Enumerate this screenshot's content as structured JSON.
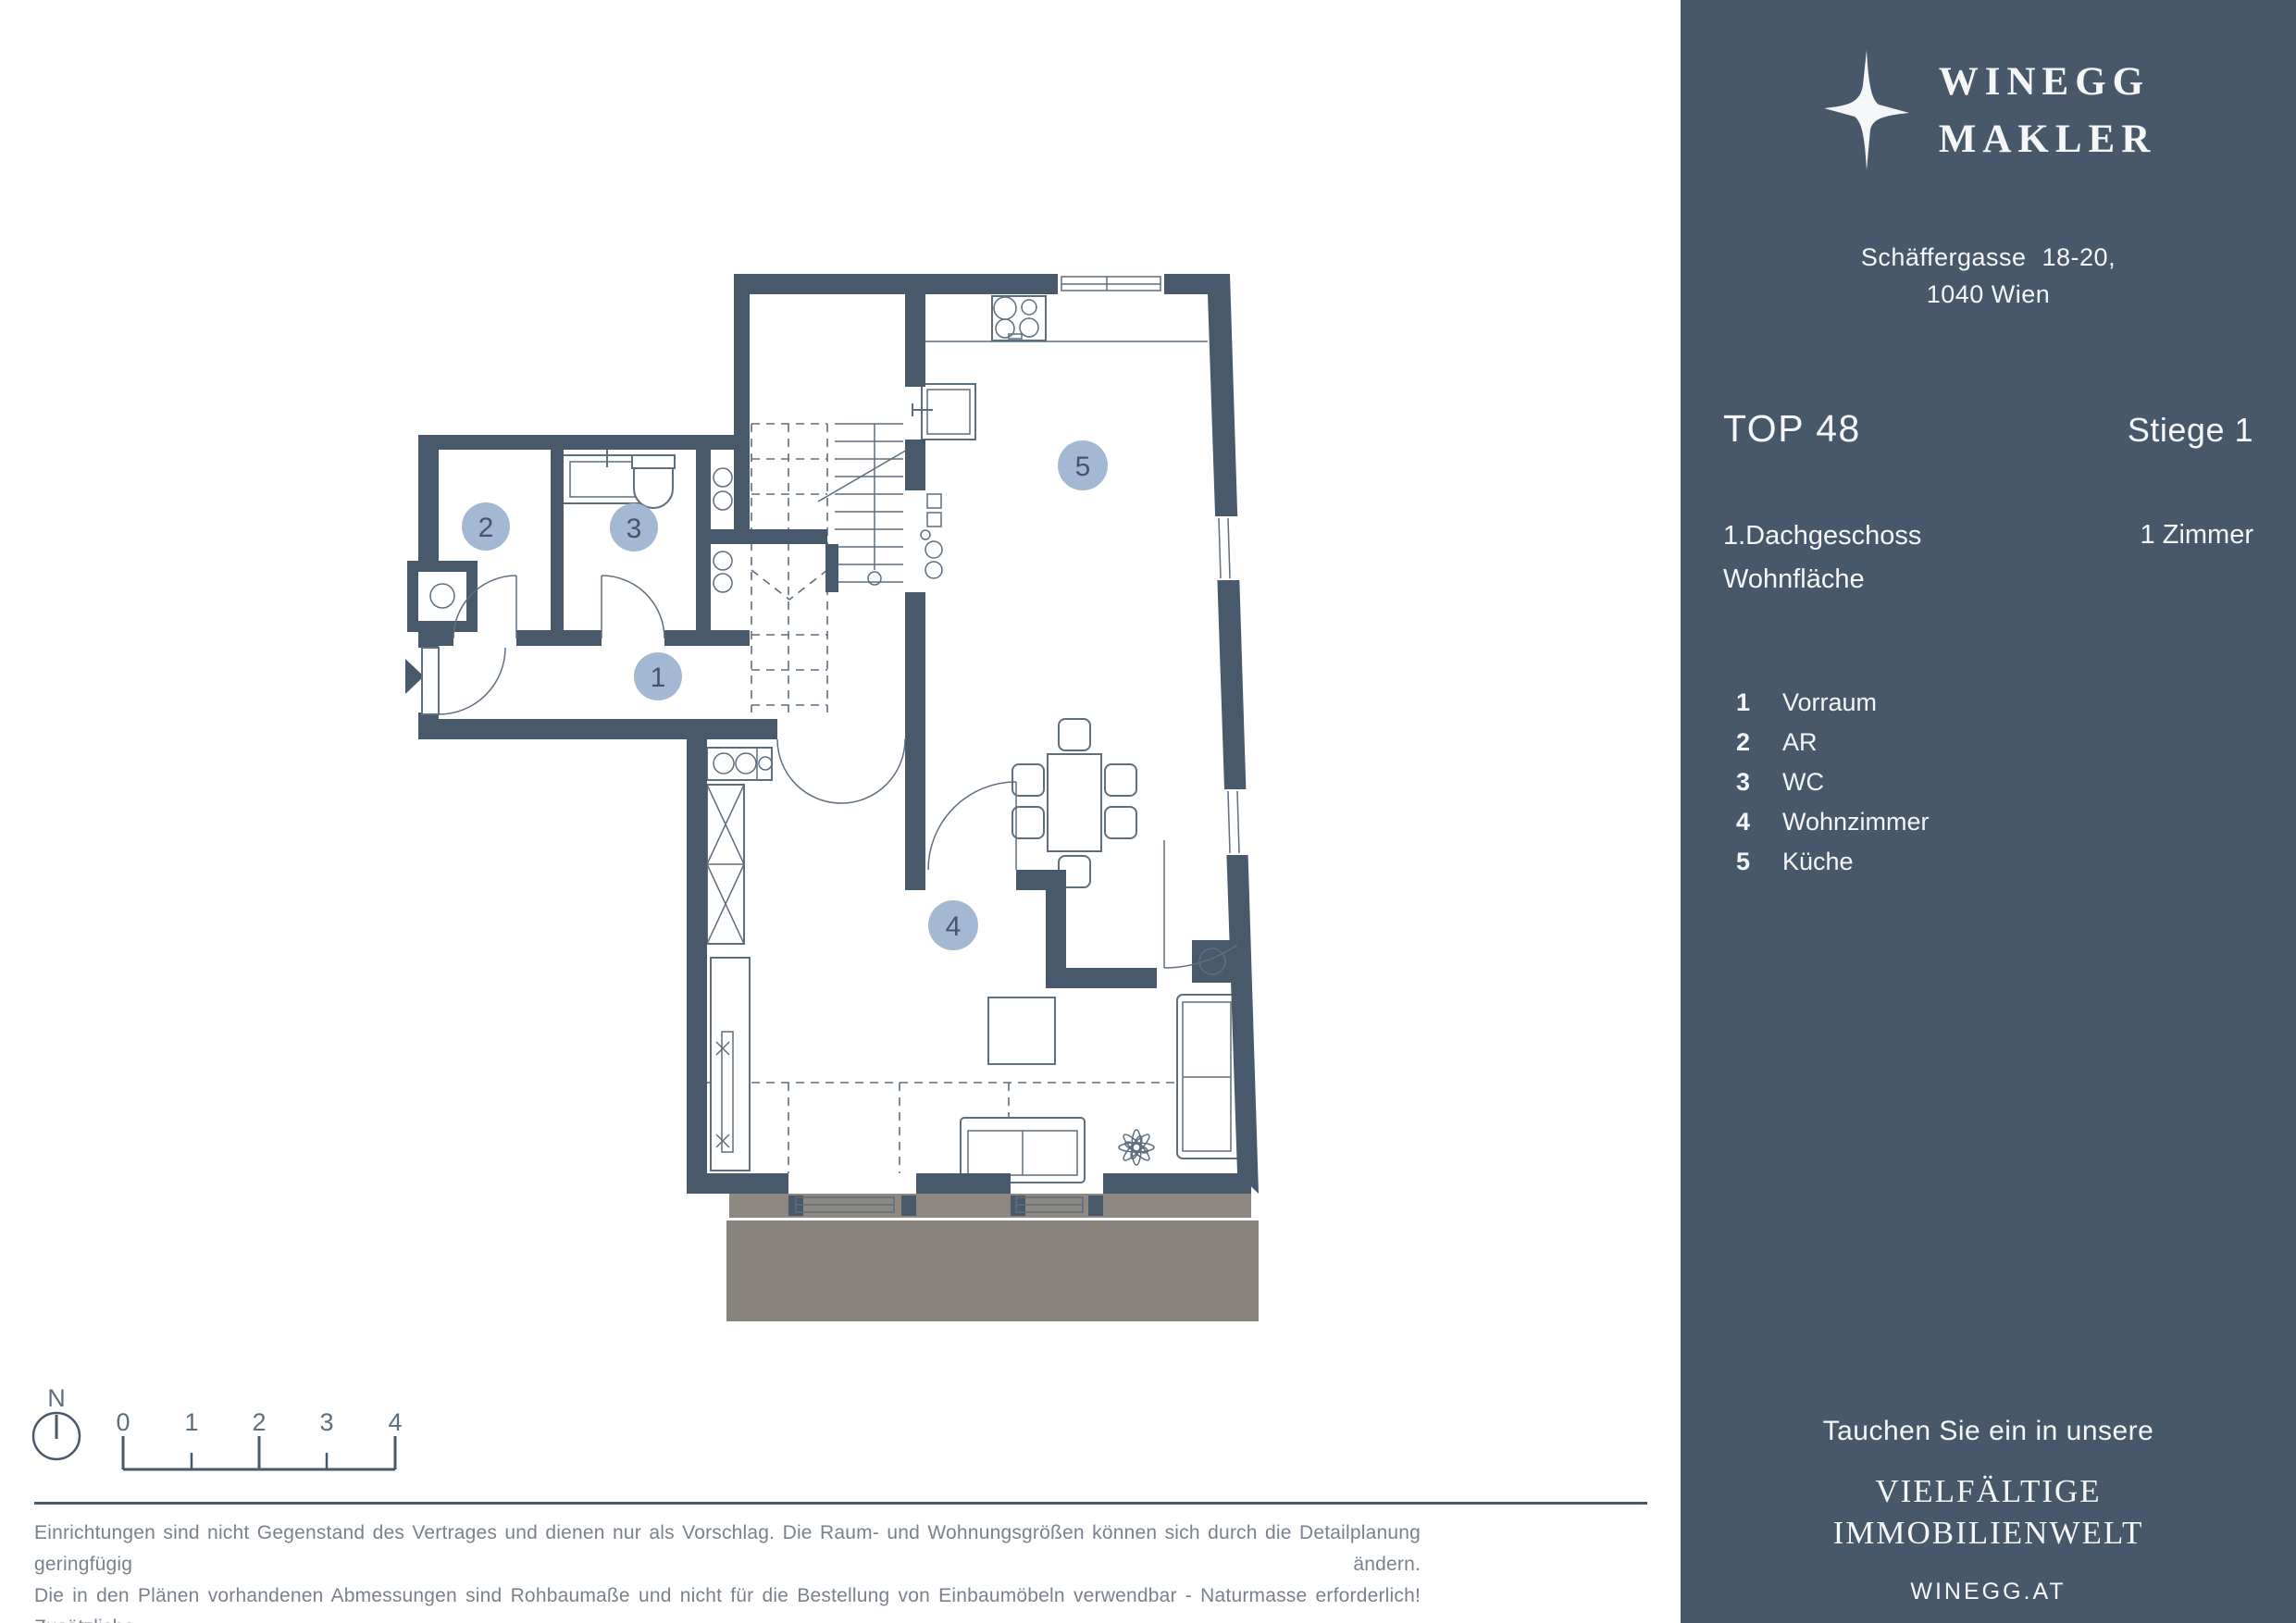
{
  "theme": {
    "wall": "#47596b",
    "furn": "#5d6e7e",
    "badge": "#a3b8d3",
    "badge_text": "#42556a",
    "terrace_main": "#87827b",
    "terrace_band": "#8d8882",
    "sidebar_bg": "#46586a",
    "sidebar_text": "#f4f6f7",
    "disclaimer_text": "#79828c"
  },
  "sidebar": {
    "logo": {
      "line1": "WINEGG",
      "line2": "MAKLER"
    },
    "address_line1": "Schäffergasse 18-20,",
    "address_line2": "1040 Wien",
    "top_label": "TOP 48",
    "stiege_label": "Stiege 1",
    "floor_label": "1.Dachgeschoss",
    "area_label": "Wohnfläche",
    "rooms_label": "1 Zimmer",
    "legend": [
      {
        "num": "1",
        "label": "Vorraum"
      },
      {
        "num": "2",
        "label": "AR"
      },
      {
        "num": "3",
        "label": "WC"
      },
      {
        "num": "4",
        "label": "Wohnzimmer"
      },
      {
        "num": "5",
        "label": "Küche"
      }
    ],
    "footer": {
      "tagline": "Tauchen Sie ein in unsere",
      "brand_line1": "VIELFÄLTIGE",
      "brand_line2": "IMMOBILIENWELT",
      "website": "WINEGG.AT"
    }
  },
  "plan": {
    "north_label": "N",
    "scale_labels": [
      "0",
      "1",
      "2",
      "3",
      "4"
    ],
    "badges": [
      "1",
      "2",
      "3",
      "4",
      "5"
    ]
  },
  "disclaimer": {
    "lines": [
      "Einrichtungen sind nicht Gegenstand des Vertrages und dienen nur als Vorschlag. Die Raum- und Wohnungsgrößen können sich durch die Detailplanung geringfügig ändern.",
      "Die in den Plänen vorhandenen Abmessungen sind Rohbaumaße und nicht für die Bestellung von Einbaumöbeln verwendbar - Naturmasse erforderlich! Zusätzliche",
      "abgehängte Decken und Poterien nach Erfordernis. Unverbindliche Plankopie, Druckfehler, Irrtum oder Änderungen vorbehalten."
    ]
  }
}
